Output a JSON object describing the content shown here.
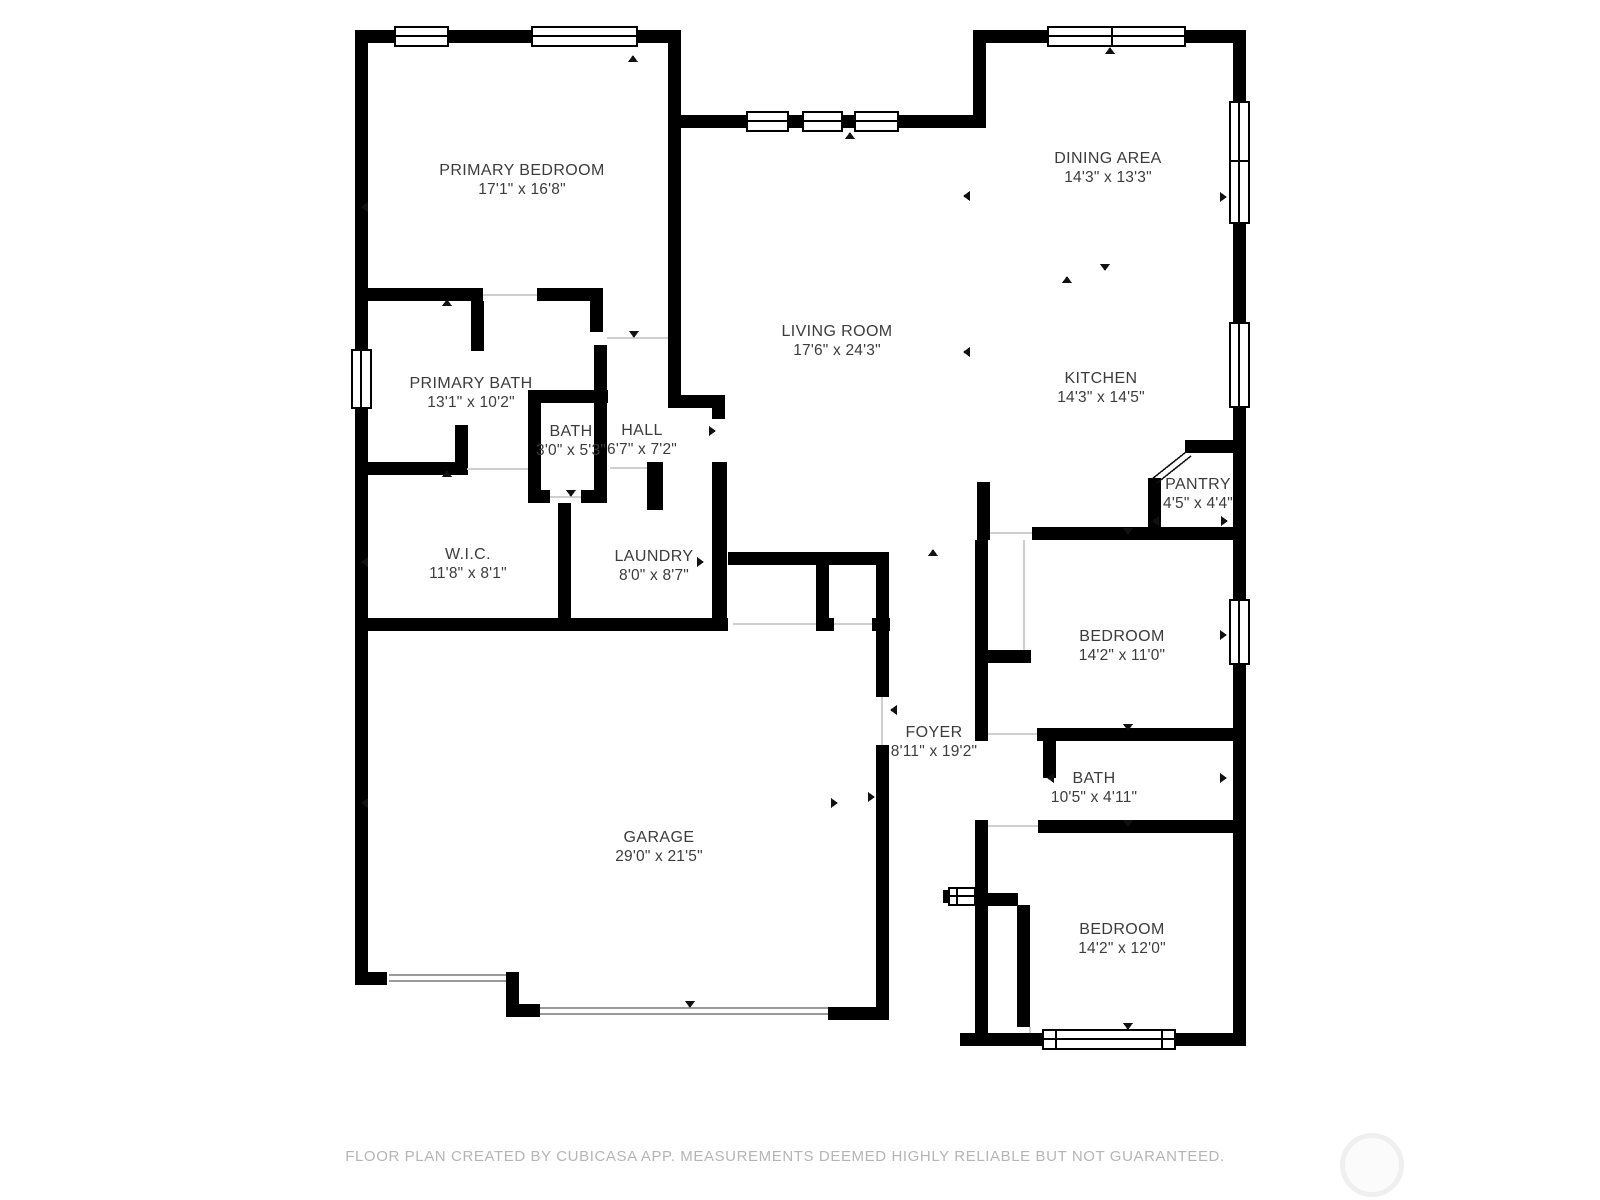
{
  "floorplan": {
    "rooms": [
      {
        "id": "primary-bedroom",
        "name": "PRIMARY BEDROOM",
        "dims": "17'1\" x 16'8\""
      },
      {
        "id": "dining-area",
        "name": "DINING AREA",
        "dims": "14'3\" x 13'3\""
      },
      {
        "id": "living-room",
        "name": "LIVING ROOM",
        "dims": "17'6\" x 24'3\""
      },
      {
        "id": "kitchen",
        "name": "KITCHEN",
        "dims": "14'3\" x 14'5\""
      },
      {
        "id": "primary-bath",
        "name": "PRIMARY BATH",
        "dims": "13'1\" x 10'2\""
      },
      {
        "id": "bath",
        "name": "BATH",
        "dims": "3'0\" x 5'3\""
      },
      {
        "id": "hall",
        "name": "HALL",
        "dims": "6'7\" x 7'2\""
      },
      {
        "id": "pantry",
        "name": "PANTRY",
        "dims": "4'5\" x 4'4\""
      },
      {
        "id": "wic",
        "name": "W.I.C.",
        "dims": "11'8\" x 8'1\""
      },
      {
        "id": "laundry",
        "name": "LAUNDRY",
        "dims": "8'0\" x 8'7\""
      },
      {
        "id": "bedroom-1",
        "name": "BEDROOM",
        "dims": "14'2\" x 11'0\""
      },
      {
        "id": "foyer",
        "name": "FOYER",
        "dims": "8'11\" x 19'2\""
      },
      {
        "id": "bath-2",
        "name": "BATH",
        "dims": "10'5\" x 4'11\""
      },
      {
        "id": "garage",
        "name": "GARAGE",
        "dims": "29'0\" x 21'5\""
      },
      {
        "id": "bedroom-2",
        "name": "BEDROOM",
        "dims": "14'2\" x 12'0\""
      }
    ],
    "footer": "FLOOR PLAN CREATED BY CUBICASA APP. MEASUREMENTS DEEMED HIGHLY RELIABLE BUT NOT GUARANTEED.",
    "colors": {
      "wall": "#000000",
      "label_text": "#3c3c3c",
      "footer_text": "#b5b5b5",
      "background": "#ffffff"
    }
  }
}
